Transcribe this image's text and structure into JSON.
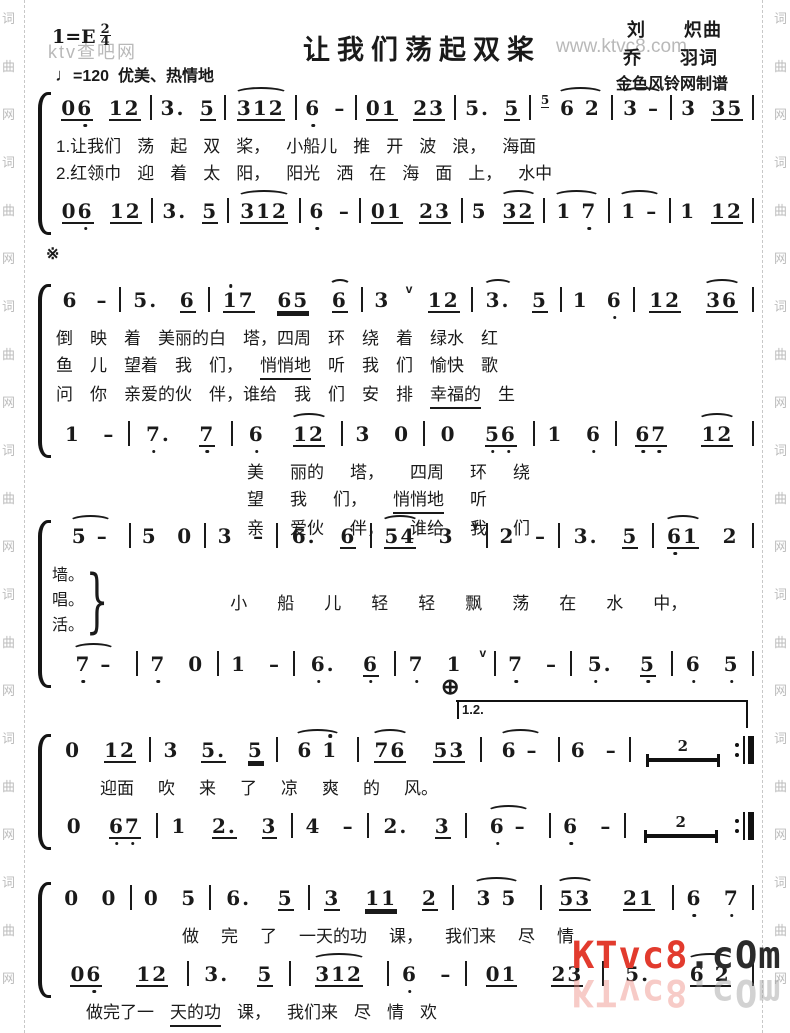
{
  "page": {
    "ink": "#1a1a1a",
    "paper": "#ffffff",
    "watermark_grey": "#b9b9b9",
    "watermark_red": "#e23b2e"
  },
  "header": {
    "key_signature": "1=E",
    "time_top": "2",
    "time_bottom": "4",
    "title": "让我们荡起双桨",
    "composer": "刘　　炽曲",
    "lyricist": "乔　　羽词",
    "arranger": "金色风铃网制谱",
    "tempo_glyph": "♩",
    "tempo_value": "=120",
    "tempo_expression": "优美、热情地"
  },
  "watermarks": {
    "top_left": "ktv查吧网",
    "site": "www.ktvc8.com",
    "bottom_red": "KTvc8",
    "bottom_dark": ".cOm",
    "edge_chars": [
      "词",
      "曲",
      "网"
    ]
  },
  "marks": {
    "segno": "※",
    "coda": "⊕",
    "volta_label": "1.2.",
    "rest_number": "2"
  },
  "systems": [
    {
      "top": 86,
      "rows": [
        {
          "type": "notes",
          "measures": [
            [
              "u1:06,",
              "u1:12"
            ],
            [
              "3.",
              "u1:5"
            ],
            [
              "~u1:312"
            ],
            [
              "6,",
              "-"
            ],
            [
              "u1:01",
              "u1:23"
            ],
            [
              "5.",
              "u1:5"
            ],
            [
              "g5",
              "~6 2"
            ],
            [
              "~3 -"
            ],
            [
              "3",
              "u1:35"
            ]
          ]
        },
        {
          "type": "lyrics",
          "pad": 4,
          "gap": 16,
          "tokens": [
            "1.让我们",
            "荡",
            "起",
            "双",
            "桨，",
            "小船儿",
            "推",
            "开",
            "波",
            "浪，",
            "海面"
          ]
        },
        {
          "type": "lyrics",
          "pad": 4,
          "gap": 16,
          "tokens": [
            "2.红领巾",
            "迎",
            "着",
            "太",
            "阳，",
            "阳光",
            "洒",
            "在",
            "海",
            "面",
            "上，",
            "水中"
          ]
        },
        {
          "type": "notes",
          "measures": [
            [
              "u1:06,",
              "u1:12"
            ],
            [
              "3.",
              "u1:5"
            ],
            [
              "~u1:312"
            ],
            [
              "6,",
              "-"
            ],
            [
              "u1:01",
              "u1:23"
            ],
            [
              "5",
              "~u1:32"
            ],
            [
              "~1 7,"
            ],
            [
              "~1 -"
            ],
            [
              "1",
              "u1:12"
            ]
          ]
        }
      ]
    },
    {
      "top": 252,
      "mark": "segno",
      "rows": [
        {
          "type": "notes",
          "mt": 26,
          "measures": [
            [
              "6",
              "-"
            ],
            [
              "5.",
              "u1:6"
            ],
            [
              "u1:1'7",
              "u2:65",
              "~u1:6"
            ],
            [
              "3",
              "v",
              "u1:12"
            ],
            [
              "~3.",
              "u1:5"
            ],
            [
              "1",
              "6,"
            ],
            [
              "u1:12",
              "~u1:36"
            ]
          ]
        },
        {
          "type": "lyrics",
          "pad": 4,
          "gap": 17,
          "tokens": [
            "倒",
            "映",
            "着",
            "美丽的白",
            "塔，四周",
            "环",
            "绕",
            "着",
            "绿水",
            "红"
          ]
        },
        {
          "type": "lyrics",
          "pad": 4,
          "gap": 17,
          "tokens": [
            "鱼",
            "儿",
            "望着",
            "我",
            "们，",
            "u:悄悄地",
            "听",
            "我",
            "们",
            "愉快",
            "歌"
          ]
        },
        {
          "type": "lyrics",
          "pad": 4,
          "gap": 17,
          "tokens": [
            "问",
            "你",
            "亲爱的伙",
            "伴，谁给",
            "我",
            "们",
            "安",
            "排",
            "u:幸福的",
            "生"
          ]
        },
        {
          "type": "notes",
          "measures": [
            [
              "1",
              "-"
            ],
            [
              "7,.",
              "u1:7,"
            ],
            [
              "6,",
              "~u1:12"
            ],
            [
              "3",
              "0"
            ],
            [
              "0",
              "u1:5,6,"
            ],
            [
              "1",
              "6,"
            ],
            [
              "u1:6,7,",
              "~u1:12"
            ]
          ]
        },
        {
          "type": "lyrics",
          "pad": 195,
          "gap": 26,
          "tokens": [
            "美",
            "丽的",
            "塔，",
            "四周",
            "环",
            "绕"
          ]
        },
        {
          "type": "lyrics",
          "pad": 195,
          "gap": 26,
          "tokens": [
            "望",
            "我",
            "们，",
            "u:悄悄地",
            "听"
          ]
        },
        {
          "type": "lyrics",
          "pad": 195,
          "gap": 26,
          "tokens": [
            "亲",
            "爱伙",
            "伴，",
            "谁给",
            "我",
            "们"
          ]
        }
      ]
    },
    {
      "top": 514,
      "rows": [
        {
          "type": "notes",
          "measures": [
            [
              "~5 -"
            ],
            [
              "5",
              "0"
            ],
            [
              "3",
              "-"
            ],
            [
              "6.",
              "u1:6"
            ],
            [
              "~u1:54",
              "3",
              "v"
            ],
            [
              "2",
              "-"
            ],
            [
              "3.",
              "u1:5"
            ],
            [
              "~u1:6,1",
              "2"
            ]
          ]
        },
        {
          "type": "merge",
          "verses": [
            "墙。",
            "唱。",
            "活。"
          ],
          "pad": 118,
          "gap": 30,
          "tokens": [
            "小",
            "船",
            "儿",
            "轻",
            "轻",
            "飘",
            "荡",
            "在",
            "水",
            "中，"
          ]
        },
        {
          "type": "notes",
          "measures": [
            [
              "~7, -"
            ],
            [
              "7,",
              "0"
            ],
            [
              "1",
              "-"
            ],
            [
              "6,.",
              "u1:6,"
            ],
            [
              "7,",
              "1",
              "v"
            ],
            [
              "7,",
              "-"
            ],
            [
              "5,.",
              "u1:5,"
            ],
            [
              "6,",
              "5,"
            ]
          ]
        }
      ]
    },
    {
      "top": 700,
      "rows": [
        {
          "type": "notes",
          "mt": 28,
          "end": "repeat",
          "measures": [
            [
              "0",
              "u1:12"
            ],
            [
              "3",
              "u1:5.",
              "u2:5"
            ],
            [
              "~6 1'"
            ],
            [
              "~u1:76",
              "u1:53"
            ],
            [
              "~6 -"
            ],
            [
              "6",
              "-"
            ],
            [
              "R2"
            ]
          ]
        },
        {
          "type": "lyrics",
          "pad": 48,
          "gap": 24,
          "tokens": [
            "迎面",
            "吹",
            "来",
            "了",
            "凉",
            "爽",
            "的",
            "风。"
          ]
        },
        {
          "type": "notes",
          "end": "repeat",
          "measures": [
            [
              "0",
              "u1:6,7,"
            ],
            [
              "1",
              "u1:2.",
              "u1:3"
            ],
            [
              "4",
              "-"
            ],
            [
              "2.",
              "u1:3"
            ],
            [
              "~6, -"
            ],
            [
              "6,",
              "-"
            ],
            [
              "R2"
            ]
          ]
        }
      ]
    },
    {
      "top": 866,
      "rows": [
        {
          "type": "notes",
          "mt": 10,
          "measures": [
            [
              "0",
              "0"
            ],
            [
              "0",
              "5"
            ],
            [
              "6.",
              "u1:5"
            ],
            [
              "u1:3",
              "u2:11",
              "u1:2"
            ],
            [
              "~3 5"
            ],
            [
              "~u1:53",
              "u1:21"
            ],
            [
              "6,",
              "7,"
            ]
          ]
        },
        {
          "type": "lyrics",
          "pad": 130,
          "gap": 22,
          "tokens": [
            "做",
            "完",
            "了",
            "一天的功",
            "课，",
            "我们来",
            "尽",
            "情"
          ]
        },
        {
          "type": "notes",
          "measures": [
            [
              "u1:06,",
              "u1:12"
            ],
            [
              "3.",
              "u1:5"
            ],
            [
              "~u1:312"
            ],
            [
              "6,",
              "-"
            ],
            [
              "u1:01",
              "u1:23"
            ],
            [
              "5.",
              "~u1:6 2"
            ]
          ]
        },
        {
          "type": "lyrics",
          "pad": 34,
          "gap": 16,
          "tokens": [
            "做完了一",
            "u:天的功",
            "课，",
            "我们来",
            "尽",
            "情",
            "欢"
          ]
        }
      ]
    }
  ]
}
